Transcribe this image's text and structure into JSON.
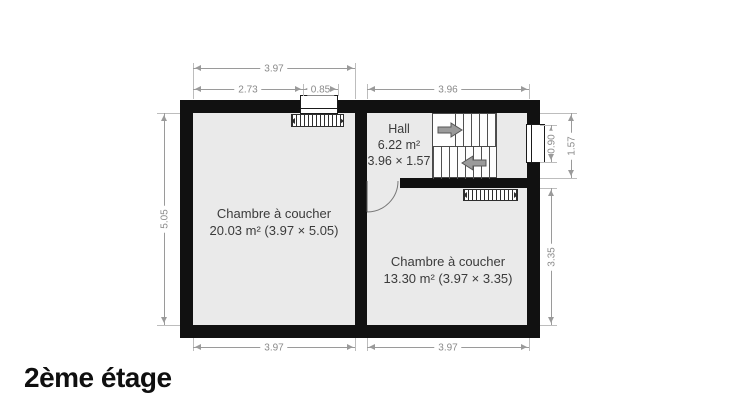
{
  "title": "2ème étage",
  "colors": {
    "wall": "#111111",
    "floor": "#eaeaea",
    "dimension": "#9a9a9a",
    "dimension_text": "#8a8a8a",
    "room_text": "#3b3b3b",
    "background": "#ffffff",
    "stair_line": "#4f4f4f",
    "stair_arrow": "#9a9a9a"
  },
  "rooms": {
    "bedroom_left": {
      "name": "Chambre à coucher",
      "details": "20.03 m² (3.97 × 5.05)"
    },
    "hall": {
      "name": "Hall",
      "area": "6.22 m²",
      "size": "3.96 × 1.57"
    },
    "bedroom_right": {
      "name": "Chambre à coucher",
      "details": "13.30 m² (3.97 × 3.35)"
    }
  },
  "dimensions": {
    "top_total": "3.97",
    "top_seg_left": "2.73",
    "top_seg_window": "0.85",
    "top_hall": "3.96",
    "left_room_height": "5.05",
    "hall_window": "0.90",
    "hall_height": "1.57",
    "right_room_height": "3.35",
    "bottom_left": "3.97",
    "bottom_right": "3.97"
  },
  "icons": {
    "stairs_up_arrow": "arrow-right",
    "stairs_down_arrow": "arrow-left"
  }
}
